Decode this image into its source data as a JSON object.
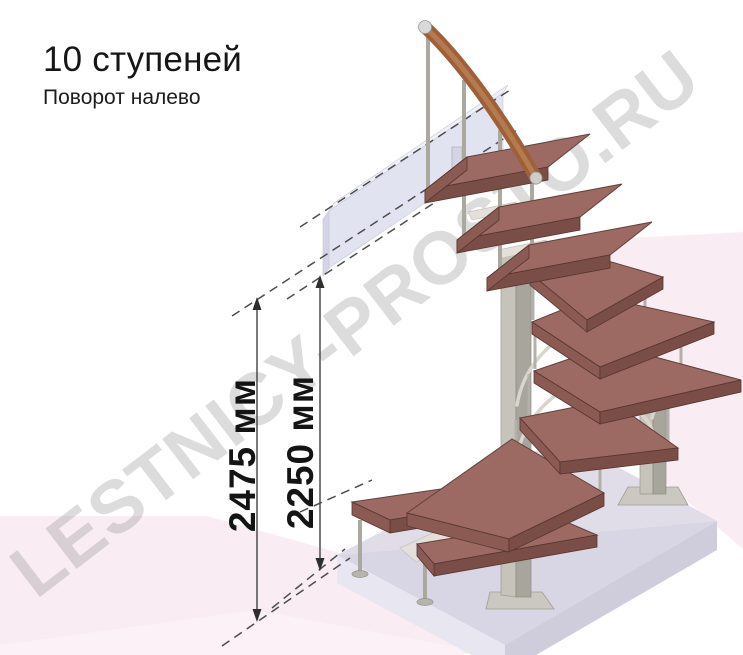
{
  "header": {
    "title": "10 ступеней",
    "subtitle": "Поворот налево"
  },
  "watermark": {
    "text": "LESTNICY-PROSTO.RU"
  },
  "dimensions": [
    {
      "id": "overall-height",
      "label": "2475 мм",
      "value": 2475,
      "unit": "мм"
    },
    {
      "id": "floor-to-landing-height",
      "label": "2250 мм",
      "value": 2250,
      "unit": "мм"
    }
  ],
  "staircase": {
    "kind": "modular staircase, isometric 3D render",
    "steps_count": 10,
    "turn_direction": "left",
    "components": [
      "wooden handrail",
      "steel balusters",
      "wooden treads",
      "winder treads around central column",
      "central steel column",
      "rear support column",
      "floor slab",
      "upper landing beam"
    ],
    "colors": {
      "tread_top": "#9c6a62",
      "tread_edge": "#7b4d47",
      "handrail_wood": "#9d6039",
      "metal": "#aba89f",
      "slab": "#dbd8e6",
      "landing_beam": "#e2e3f1",
      "background_pink": "#f9edf3",
      "watermark_gray": "#d9d9d9",
      "annotation": "#2e2e2e"
    }
  }
}
